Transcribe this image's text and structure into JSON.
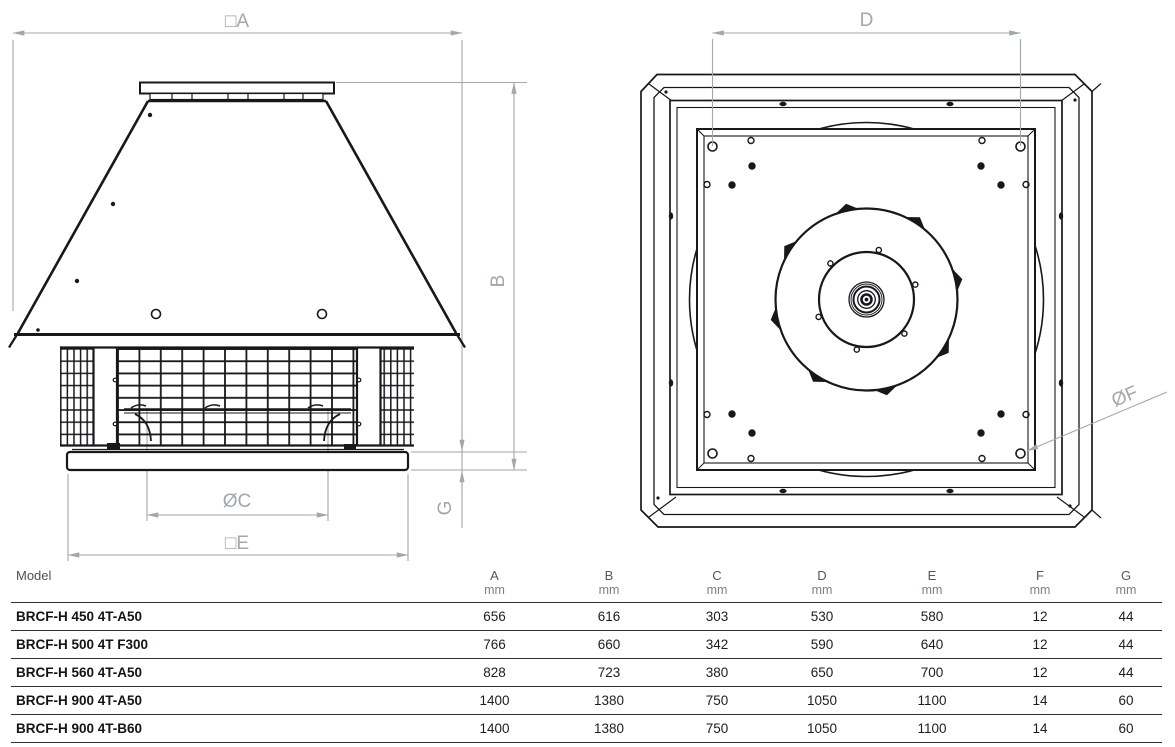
{
  "drawing": {
    "front_view": {
      "label_A": "□A",
      "label_B": "B",
      "label_C": "ØC",
      "label_E": "□E",
      "label_G": "G"
    },
    "top_view": {
      "label_D": "D",
      "label_F": "ØF"
    }
  },
  "table": {
    "model_header": "Model",
    "unit": "mm",
    "columns": [
      "A",
      "B",
      "C",
      "D",
      "E",
      "F",
      "G"
    ],
    "rows": [
      {
        "model": "BRCF-H 450 4T-A50",
        "A": "656",
        "B": "616",
        "C": "303",
        "D": "530",
        "E": "580",
        "F": "12",
        "G": "44"
      },
      {
        "model": "BRCF-H 500 4T F300",
        "A": "766",
        "B": "660",
        "C": "342",
        "D": "590",
        "E": "640",
        "F": "12",
        "G": "44"
      },
      {
        "model": "BRCF-H 560 4T-A50",
        "A": "828",
        "B": "723",
        "C": "380",
        "D": "650",
        "E": "700",
        "F": "12",
        "G": "44"
      },
      {
        "model": "BRCF-H 900 4T-A50",
        "A": "1400",
        "B": "1380",
        "C": "750",
        "D": "1050",
        "E": "1100",
        "F": "14",
        "G": "60"
      },
      {
        "model": "BRCF-H 900 4T-B60",
        "A": "1400",
        "B": "1380",
        "C": "750",
        "D": "1050",
        "E": "1100",
        "F": "14",
        "G": "60"
      }
    ]
  },
  "colors": {
    "line": "#17181a",
    "dimension": "#a2a7ac",
    "table_border": "#2c2d30"
  }
}
